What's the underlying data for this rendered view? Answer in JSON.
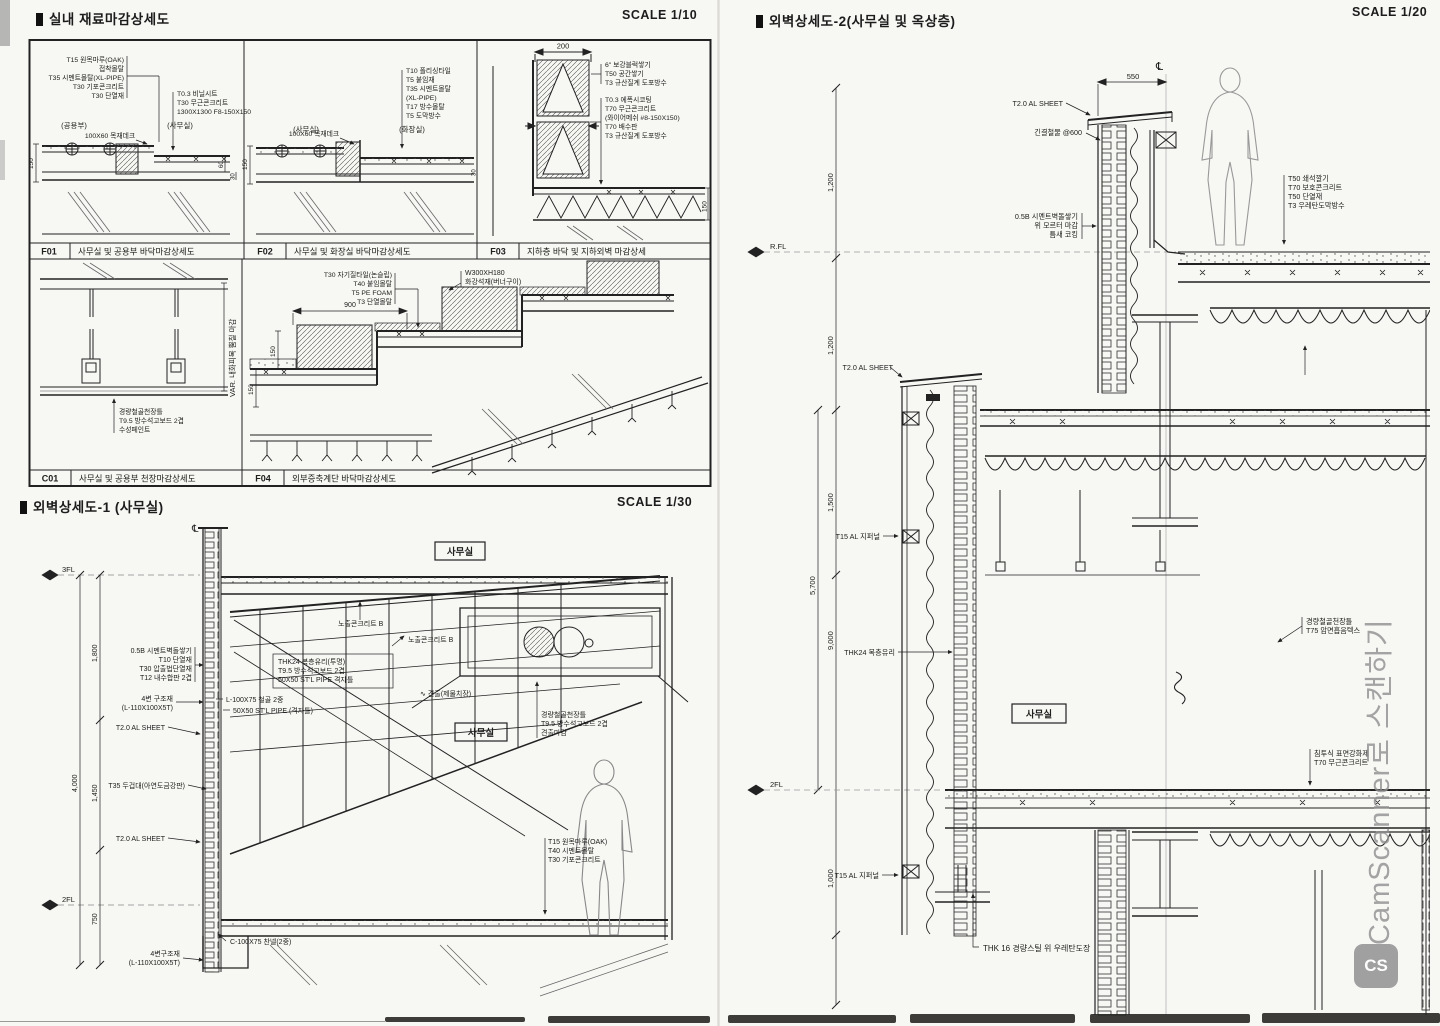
{
  "sheet": {
    "left_top": {
      "title": "실내 재료마감상세도",
      "scale": "SCALE 1/10",
      "f01": {
        "code": "F01",
        "caption": "사무실 및 공용부 바닥마감상세도",
        "left_stack": [
          "T15 원목마루(OAK)",
          "접착몰탈",
          "T35 시멘트몰탈(XL-PIPE)",
          "T30 기포콘크리트",
          "T30 단열재"
        ],
        "right_stack": [
          "T0.3 비닐시트",
          "T30 무근콘크리트",
          "1300X1300 F8-150X150"
        ],
        "center_label": "100X60 목재데크",
        "rooms": [
          "(공용부)",
          "(사무실)"
        ],
        "dims": [
          "150",
          "60",
          "30"
        ]
      },
      "f02": {
        "code": "F02",
        "caption": "사무실 및 화장실 바닥마감상세도",
        "right_stack": [
          "T10 폴리싱타일",
          "T5 붙임재",
          "T35 시멘트몰탈",
          "(XL-PIPE)",
          "T17 방수몰탈",
          "T5 도막방수"
        ],
        "center_label": "100X60 목재데크",
        "rooms": [
          "(사무실)",
          "(화장실)"
        ],
        "dims": [
          "150",
          "30"
        ]
      },
      "f03": {
        "code": "F03",
        "caption": "지하층 바닥 및 지하외벽 마감상세",
        "stack_a": [
          "6\" 보강블럭쌓기",
          "T50 공간쌓기",
          "T3 규산질계 도포방수"
        ],
        "stack_b": [
          "T0.3 에폭시코팅",
          "T70 무근콘크리트",
          "(와이어메쉬 #8-150X150)",
          "T70 배수판",
          "T3 규산질계 도포방수"
        ],
        "dims": [
          "200",
          "150"
        ]
      },
      "c01": {
        "code": "C01",
        "caption": "사무실 및 공용부 천장마감상세도",
        "stack": [
          "경량철골천장틀",
          "T9.5 방수석고보드 2겹",
          "수성페인트"
        ],
        "side_text": "VAR. 내화피복 뿜칠 마감"
      },
      "f04": {
        "code": "F04",
        "caption": "외부증축계단 바닥마감상세도",
        "stack": [
          "T30 자기질타일(논슬립)",
          "T40 붙임몰탈",
          "T5 PE FOAM",
          "T3 단열몰탈"
        ],
        "stone_label": [
          "W300XH180",
          "화강석재(버너구이)"
        ],
        "dims": [
          "900",
          "150",
          "150"
        ]
      }
    },
    "left_bottom": {
      "title": "외벽상세도-1 (사무실)",
      "scale": "SCALE 1/30",
      "cl": "℄",
      "rooms": [
        "사무실",
        "사무실"
      ],
      "levels": [
        "3FL",
        "2FL"
      ],
      "dims": [
        "1,800",
        "4,000",
        "1,450",
        "750"
      ],
      "labels": {
        "wall_stack": [
          "0.5B 시멘트벽돌쌓기",
          "T10 단열재",
          "T30 압출법단열재",
          "T12 내수합판 2겹"
        ],
        "conc_b1": "노출콘크리트 B",
        "conc_b2": "노출콘크리트 B",
        "glass_stack": [
          "THK24 복층유리(투명)",
          "T9.5 방수석고보드 2겹",
          "50X50 ST'L PIPE 격자틀"
        ],
        "frame1": [
          "4변 구조재",
          "(L-110X100X5T)"
        ],
        "steel1": "L-100X75 철골 2중",
        "steel2": "50X50 ST'L PIPE (격자틀)",
        "al1": "T2.0 AL SHEET",
        "cap": "T35 두겁대(아연도금강판)",
        "al2": "T2.0 AL SHEET",
        "channel": "C-100X75 찬넬(2중)",
        "frame2": [
          "4변구조재",
          "(L-110X100X5T)"
        ],
        "floor_stack": [
          "T15 원목마루(OAK)",
          "T40 시멘트몰탈",
          "T30 기포콘크리트"
        ],
        "ceil_stack": [
          "경량철골천장틀",
          "T9.5 방수석고보드 2겹",
          "견출마감"
        ],
        "chamfer": "∿ 견출(제물치장)"
      }
    },
    "right": {
      "title": "외벽상세도-2(사무실 및 옥상층)",
      "scale": "SCALE 1/20",
      "cl": "℄",
      "room": "사무실",
      "levels": [
        "R.FL",
        "2FL"
      ],
      "dims": [
        "550",
        "1,200",
        "1,200",
        "1,500",
        "5,700",
        "9,000",
        "1,000"
      ],
      "labels": {
        "al_top": "T2.0 AL SHEET",
        "anchor": "긴결철물 @600",
        "parapet_stack": [
          "0.5B 시멘트벽돌쌓기",
          "위 모르터 마감",
          "틈새 코킹"
        ],
        "roof_stack": [
          "T50 쇄석깔기",
          "T70 보호콘크리트",
          "T50 단열재",
          "T3 우레탄도막방수"
        ],
        "al_mid": "T2.0 AL SHEET",
        "louver1": "T15 AL 지퍼널",
        "glass": "THK24 복층유리",
        "ceil_stack": [
          "경량철골천장틀",
          "T75 암면흡음텍스"
        ],
        "hardener_stack": [
          "침투식 표면강화제",
          "T70 무근콘크리트"
        ],
        "louver2": "T15 AL 지퍼널",
        "bottom": "THK 16 경량스틸 위 우레탄도장"
      }
    },
    "watermark": {
      "text": "CamScanner로 스캔하기",
      "logo": "CS"
    }
  }
}
